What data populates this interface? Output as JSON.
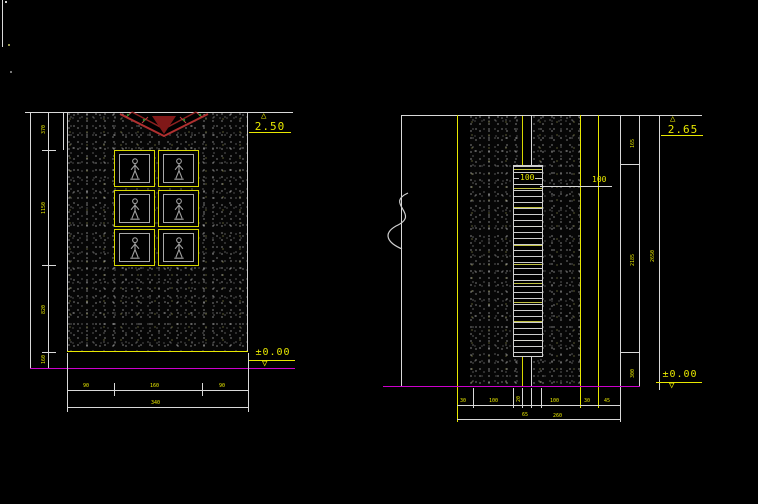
{
  "palette": {
    "background": "#000000",
    "line_white": "#d9d9d9",
    "dim_yellow": "#e8e800",
    "ground_magenta": "#cc00cc",
    "plant_red": "#b03030",
    "plant_green": "#2e8b2e",
    "figure_gray": "#a0a0a0"
  },
  "left_view": {
    "top_level": "2.50",
    "ground_level": "±0.00",
    "side_dims": [
      "370",
      "1150",
      "820",
      "160"
    ],
    "bottom_dims": [
      "90",
      "160",
      "90"
    ],
    "bottom_total": "340",
    "panel_grid": {
      "rows": 3,
      "cols": 2
    }
  },
  "right_view": {
    "top_level": "2.65",
    "ground_level": "±0.00",
    "post_label_inner": "100",
    "post_label_outer": "100",
    "side_dims": [
      "165",
      "2185",
      "300"
    ],
    "side_total": "2650",
    "bottom_dims": [
      "30",
      "100",
      "20",
      "100",
      "30",
      "45"
    ],
    "bottom_totals": [
      "65",
      "260"
    ]
  }
}
